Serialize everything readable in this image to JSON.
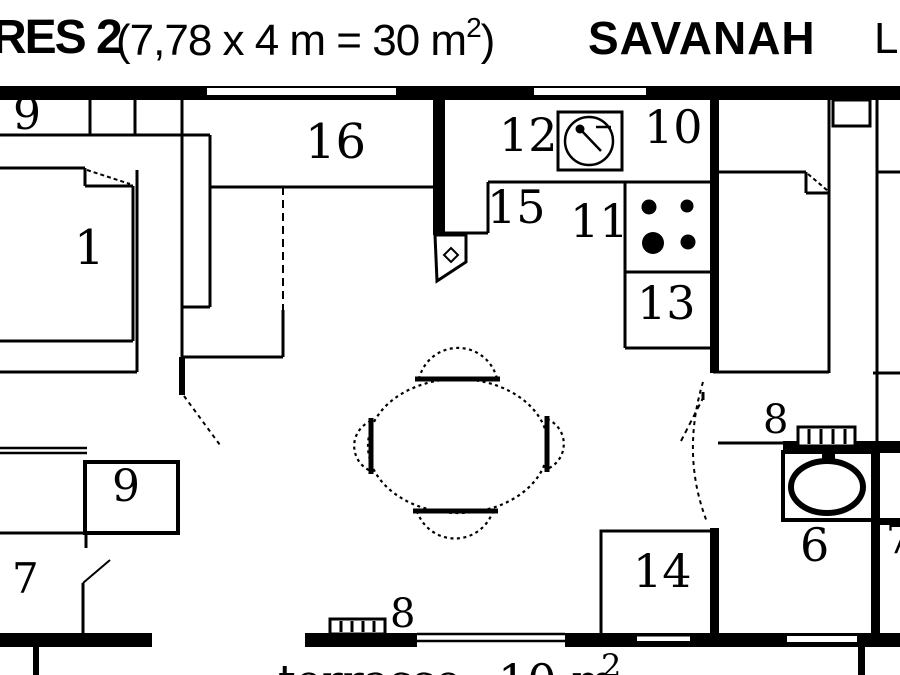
{
  "title": {
    "model": "RES 2",
    "dims_open": "(7,78 x 4 m = 30 m",
    "dims_sup": "2",
    "dims_close": ")",
    "brand": "SAVANAH",
    "right_partial": "L"
  },
  "rooms": {
    "bedroom_main": "1",
    "bathroom": "6",
    "wc": "7",
    "vent_terrace": "8",
    "vent_bath": "8",
    "wardrobe_top": "9",
    "wardrobe_mid": "9",
    "kitchen_upper": "10",
    "hob": "11",
    "sink": "12",
    "oven": "13",
    "shower": "14",
    "counter": "15",
    "wardrobe_16": "16",
    "right_edge_partial": "7"
  },
  "terrace": {
    "label": "terrasse",
    "area": "10 m",
    "area_sup": "2"
  },
  "colors": {
    "ink": "#000000",
    "paper": "#ffffff"
  }
}
